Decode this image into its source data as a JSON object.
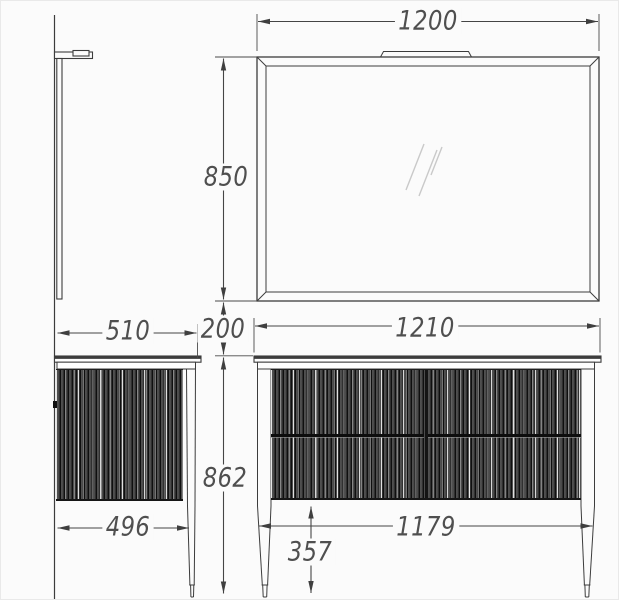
{
  "drawing": {
    "type": "furniture-dimension-drawing",
    "subject": "bathroom vanity cabinet with mirror, side and front orthographic views"
  },
  "dimensions": {
    "mirror_width": "1200",
    "mirror_height": "850",
    "wall_gap": "200",
    "vanity_depth_top": "510",
    "vanity_depth_body": "496",
    "vanity_height": "862",
    "vanity_width_top": "1210",
    "vanity_width_body": "1179",
    "leg_clearance": "357"
  },
  "colors": {
    "background": "#fbfbfb",
    "outline": "#3c3c3c",
    "dimension_line": "#474747",
    "dimension_text": "#4f4f4f",
    "mirror_hatch": "#c9c9c9",
    "flute_dark": "#0f0f0f",
    "flute_mid": "#474747"
  }
}
